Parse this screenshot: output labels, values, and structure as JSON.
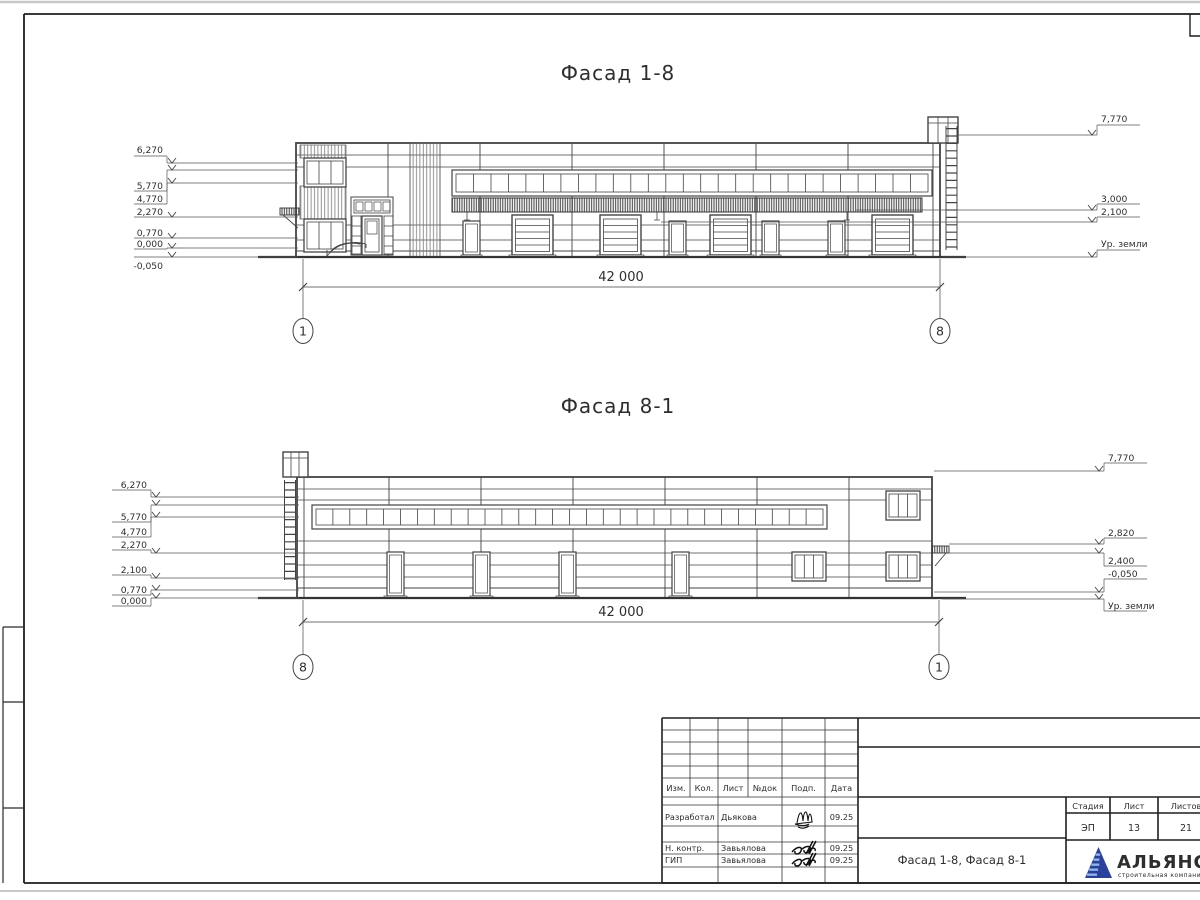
{
  "sheet": {
    "facades": [
      {
        "title": "Фасад 1-8",
        "dimension": "42 000",
        "axis_left": "1",
        "axis_right": "8",
        "left_marks": [
          {
            "label": "6,270",
            "ty": 153,
            "sy": 156,
            "ly": 163
          },
          {
            "label": "5,770",
            "ty": 189,
            "sy": 191,
            "ly": 170
          },
          {
            "label": "4,770",
            "ty": 202,
            "sy": 204,
            "ly": 183
          },
          {
            "label": "2,270",
            "ty": 215,
            "sy": 217,
            "ly": 217
          },
          {
            "label": "0,770",
            "ty": 236,
            "sy": 238,
            "ly": 238
          },
          {
            "label": "0,000",
            "ty": 247,
            "sy": 249,
            "ly": 248
          },
          {
            "label": "-0,050",
            "ty": 269,
            "sy": 257,
            "ly": 257
          }
        ],
        "right_marks": [
          {
            "label": "7,770",
            "ty": 122,
            "sy": 125,
            "ly": 135,
            "fx": 958
          },
          {
            "label": "3,000",
            "ty": 202,
            "sy": 204,
            "ly": 210,
            "fx": 856
          },
          {
            "label": "2,100",
            "ty": 215,
            "sy": 217,
            "ly": 222,
            "fx": 661
          },
          {
            "label": "Ур. земли",
            "ty": 247,
            "sy": 250,
            "ly": 257,
            "fx": 942
          }
        ]
      },
      {
        "title": "Фасад 8-1",
        "dimension": "42 000",
        "axis_left": "8",
        "axis_right": "1",
        "left_marks": [
          {
            "label": "6,270",
            "ty": 488,
            "sy": 490,
            "ly": 497
          },
          {
            "label": "5,770",
            "ty": 520,
            "sy": 522,
            "ly": 505
          },
          {
            "label": "4,770",
            "ty": 535,
            "sy": 537,
            "ly": 517
          },
          {
            "label": "2,270",
            "ty": 548,
            "sy": 550,
            "ly": 553
          },
          {
            "label": "2,100",
            "ty": 573,
            "sy": 575,
            "ly": 578
          },
          {
            "label": "0,770",
            "ty": 593,
            "sy": 595,
            "ly": 590
          },
          {
            "label": "0,000",
            "ty": 604,
            "sy": 606,
            "ly": 598
          }
        ],
        "right_marks": [
          {
            "label": "7,770",
            "ty": 461,
            "sy": 463,
            "ly": 471,
            "fx": 934
          },
          {
            "label": "2,820",
            "ty": 536,
            "sy": 538,
            "ly": 544,
            "fx": 949
          },
          {
            "label": "2,400",
            "ty": 564,
            "sy": 566,
            "ly": 553,
            "fx": 949
          },
          {
            "label": "-0,050",
            "ty": 577,
            "sy": 579,
            "ly": 592,
            "fx": 934
          },
          {
            "label": "Ур. земли",
            "ty": 609,
            "sy": 611,
            "ly": 599,
            "fx": 942
          }
        ]
      }
    ],
    "title_block": {
      "change_header": [
        "Изм.",
        "Кол.",
        "Лист",
        "№док",
        "Подп.",
        "Дата"
      ],
      "sign_rows": [
        {
          "role": "Разработал",
          "name": "Дьякова",
          "date": "09.25"
        },
        {
          "role": "Н. контр.",
          "name": "Завьялова",
          "date": "09.25"
        },
        {
          "role": "ГИП",
          "name": "Завьялова",
          "date": "09.25"
        }
      ],
      "doc_title": "Фасад 1-8, Фасад 8-1",
      "stage_header": [
        "Стадия",
        "Лист",
        "Листов"
      ],
      "stage_values": [
        "ЭП",
        "13",
        "21"
      ],
      "logo": {
        "name": "АЛЬЯНС",
        "tagline": "строительная компания",
        "color": "#2b3f9e",
        "stripe_color": "#8fb9e4",
        "tagline_color": "#6aa0d8"
      }
    }
  }
}
